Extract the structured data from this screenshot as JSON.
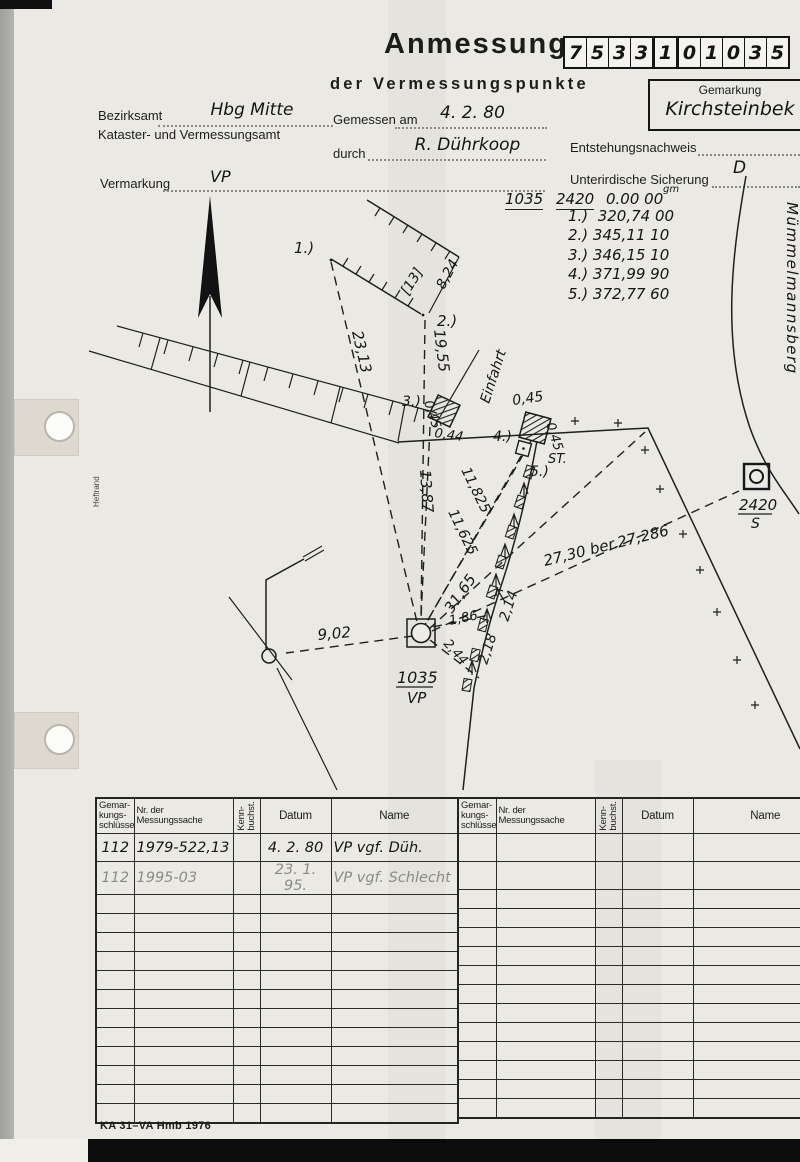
{
  "header": {
    "title": "Anmessung",
    "subtitle": "der Vermessungspunkte",
    "boxes": [
      "7",
      "5",
      "3",
      "3",
      "1",
      "0",
      "1",
      "0",
      "3",
      "5"
    ],
    "gemarkung": {
      "label": "Gemarkung",
      "value": "Kirchsteinbek"
    },
    "bezirksamt": {
      "label": "Bezirksamt",
      "value": "Hbg  Mitte"
    },
    "amt_line": "Kataster- und Vermessungsamt",
    "gemessen": {
      "label": "Gemessen am",
      "value": "4. 2. 80"
    },
    "durch": {
      "label": "durch",
      "value": "R. Dührkoop"
    },
    "entstehung_label": "Entstehungsnachweis",
    "sicherung": {
      "label": "Unterirdische Sicherung",
      "value": "D"
    },
    "vermarkung": {
      "label": "Vermarkung",
      "value": "VP"
    }
  },
  "observations": {
    "point": "1035",
    "ref": "2420",
    "zero": "0.00 00",
    "unit": "gm",
    "bearings": [
      "1.)  320,74 00",
      "2.) 345,11 10",
      "3.) 346,15 10",
      "4.) 371,99 90",
      "5.) 372,77 60"
    ]
  },
  "sketch": {
    "street": "Mümmelmannsberg",
    "heftrand": "Heftrand",
    "einfahrt": "Einfahrt",
    "st": "ST.",
    "building": "[13]",
    "p1": "1.)",
    "p2": "2.)",
    "p3": "3.)",
    "p4": "4.)",
    "p5": "5.)",
    "vp_no": "1035",
    "vp_type": "VP",
    "s_no": "2420",
    "s_type": "S",
    "m_23_13": "23,13",
    "m_19_55": "19,55",
    "m_13_87": "13,87",
    "m_11_825": "11,825",
    "m_11_625": "11,625",
    "m_31_65": "31,65",
    "m_9_02": "9,02",
    "m_1_86": "1,86",
    "m_2_44": "2,44",
    "m_2_18": "2,18",
    "m_2_14": "2,14",
    "m_8_24": "8,24",
    "m_0_45_a": "0,45",
    "m_0_44": "0,44",
    "m_0_45_b": "0,45",
    "m_0_45_c": "0,45",
    "m_27": "27,30 ber.27,286"
  },
  "table": {
    "headers": {
      "gemarkung": "Gemar-\nkungs-\nschlüssel",
      "nr": "Nr. der\nMessungssache",
      "kenn": "Kenn-\nbuchst.",
      "datum": "Datum",
      "name": "Name"
    },
    "rows": [
      [
        "112",
        "1979-522,13",
        "",
        "4. 2. 80",
        "VP vgf. Düh."
      ],
      [
        "112",
        "1995-03",
        "",
        "23. 1. 95.",
        "VP vgf. Schlecht"
      ]
    ]
  },
  "footer": {
    "form_id": "KA 31–VA Hmb 1976"
  }
}
